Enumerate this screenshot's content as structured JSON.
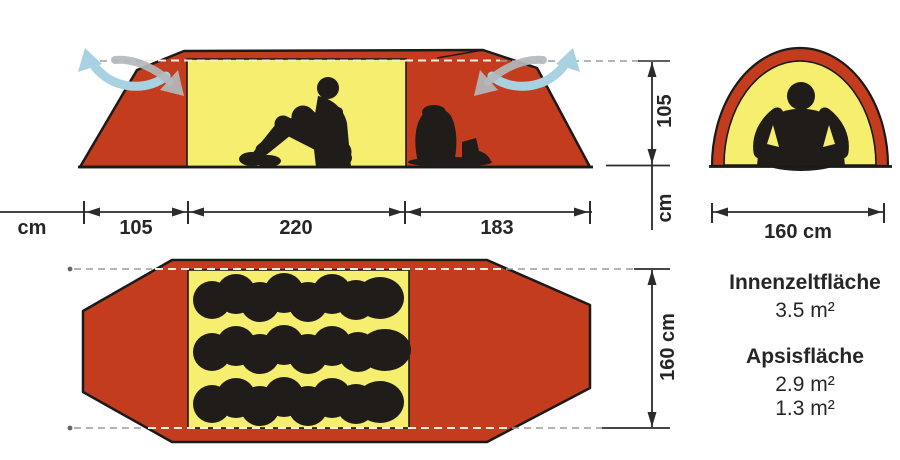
{
  "colors": {
    "tent_red": "#c43c1e",
    "inner_yellow": "#f6ee6e",
    "silhouette_black": "#201c1a",
    "airflow_blue": "#a8d1e2",
    "airflow_gray": "#b2b8bc",
    "dimension_line": "#2b2b2b"
  },
  "side_view": {
    "length_unit": "cm",
    "length_segments": [
      "105",
      "220",
      "183"
    ],
    "height_value": "105",
    "height_unit": "cm"
  },
  "front_view": {
    "width_label": "160 cm"
  },
  "floor_plan": {
    "width_label": "160 cm"
  },
  "areas": {
    "inner_label": "Innenzeltfläche",
    "inner_value": "3.5 m²",
    "apsis_label": "Apsisfläche",
    "apsis_values": [
      "2.9 m²",
      "1.3 m²"
    ]
  }
}
